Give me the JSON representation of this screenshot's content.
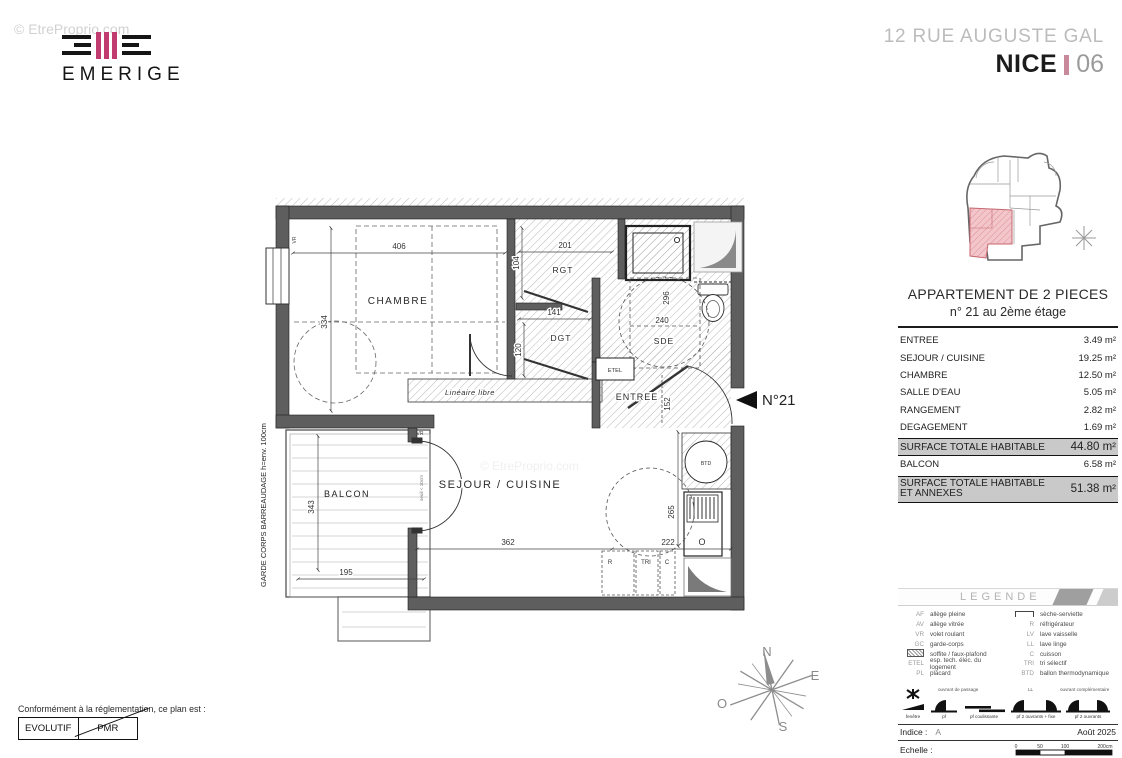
{
  "watermark": "© EtreProprio.com",
  "logo": {
    "brand": "EMERIGE"
  },
  "header": {
    "address": "12 RUE AUGUSTE GAL",
    "city": "NICE",
    "dept": "06"
  },
  "colors": {
    "brand_pink": "#c23b6e",
    "separator_pink": "#c8899b",
    "wall_gray": "#5e5e5e",
    "summary_gray": "#c9c9c9",
    "keyplan_pink": "#f3c6cb"
  },
  "apartment": {
    "title": "APPARTEMENT DE 2 PIECES",
    "subtitle": "n° 21 au 2ème étage",
    "rows": [
      {
        "label": "ENTREE",
        "value": "3.49 m²"
      },
      {
        "label": "SEJOUR / CUISINE",
        "value": "19.25 m²"
      },
      {
        "label": "CHAMBRE",
        "value": "12.50 m²"
      },
      {
        "label": "SALLE D'EAU",
        "value": "5.05 m²"
      },
      {
        "label": "RANGEMENT",
        "value": "2.82 m²"
      },
      {
        "label": "DEGAGEMENT",
        "value": "1.69 m²"
      }
    ],
    "summary1": {
      "label": "SURFACE TOTALE HABITABLE",
      "value": "44.80 m²"
    },
    "balcon": {
      "label": "BALCON",
      "value": "6.58 m²"
    },
    "summary2": {
      "label": "SURFACE TOTALE HABITABLE ET ANNEXES",
      "value": "51.38 m²"
    }
  },
  "plan": {
    "marker": "N°21",
    "labels": {
      "chambre": "CHAMBRE",
      "rgt": "RGT",
      "dgt": "DGT",
      "sde": "SDE",
      "entree": "ENTREE",
      "sejour": "SEJOUR / CUISINE",
      "balcon": "BALCON",
      "etel": "ETEL",
      "btd": "BTD",
      "o": "O",
      "lineaire": "Linéaire libre",
      "garde_corps": "GARDE CORPS BARREAUDAGE  h=env. 100cm",
      "vr": "VR",
      "seuil": "seuil < 10cm",
      "r": "R",
      "tri": "TRI",
      "c": "C"
    },
    "dims": {
      "chambre_w": "406",
      "chambre_h": "334",
      "rgt_w": "201",
      "rgt_h": "104",
      "dgt_w": "141",
      "dgt_h": "120",
      "sde_h": "296",
      "sde_c": "240",
      "entree_h": "152",
      "sejour_w": "362",
      "kitchen_w": "222",
      "kitchen_h": "265",
      "balcon_h": "343",
      "balcon_w": "195"
    }
  },
  "compass": {
    "n": "N",
    "e": "E",
    "s": "S",
    "o": "O"
  },
  "conformity": {
    "intro": "Conformément à la réglementation, ce plan est :",
    "evolutif": "EVOLUTIF",
    "pmr": "PMR"
  },
  "legend": {
    "title": "LEGENDE",
    "left": [
      {
        "abbr": "AF",
        "label": "allège pleine"
      },
      {
        "abbr": "AV",
        "label": "allège vitrée"
      },
      {
        "abbr": "VR",
        "label": "volet roulant"
      },
      {
        "abbr": "GC",
        "label": "garde-corps"
      },
      {
        "abbr": "",
        "icon": "soffit-hatch-icon",
        "label": "soffite / faux-plafond"
      },
      {
        "abbr": "ETEL",
        "label": "esp. tech. élec. du logement"
      },
      {
        "abbr": "PL",
        "label": "placard"
      }
    ],
    "right": [
      {
        "abbr": "",
        "icon": "towel-rail-icon",
        "label": "sèche-serviette"
      },
      {
        "abbr": "R",
        "label": "réfrigérateur"
      },
      {
        "abbr": "LV",
        "label": "lave vaisselle"
      },
      {
        "abbr": "LL",
        "label": "lave linge"
      },
      {
        "abbr": "C",
        "label": "cuisson"
      },
      {
        "abbr": "TRI",
        "label": "tri sélectif"
      },
      {
        "abbr": "BTD",
        "label": "ballon thermodynamique"
      }
    ],
    "annotations": {
      "a1": "ouvrant de passage",
      "a2": "LL",
      "a3": "ouvrant complémentaire"
    },
    "glyphs": [
      "fenêtre",
      "pf",
      "pf coulissante",
      "pf 2 ouvrants + fixe",
      "pf 2 ouvrants"
    ],
    "indice_label": "Indice :",
    "indice_value": "A",
    "date": "Août 2025",
    "echelle_label": "Echelle :",
    "scale": [
      "0",
      "50",
      "100",
      "200cm"
    ]
  }
}
